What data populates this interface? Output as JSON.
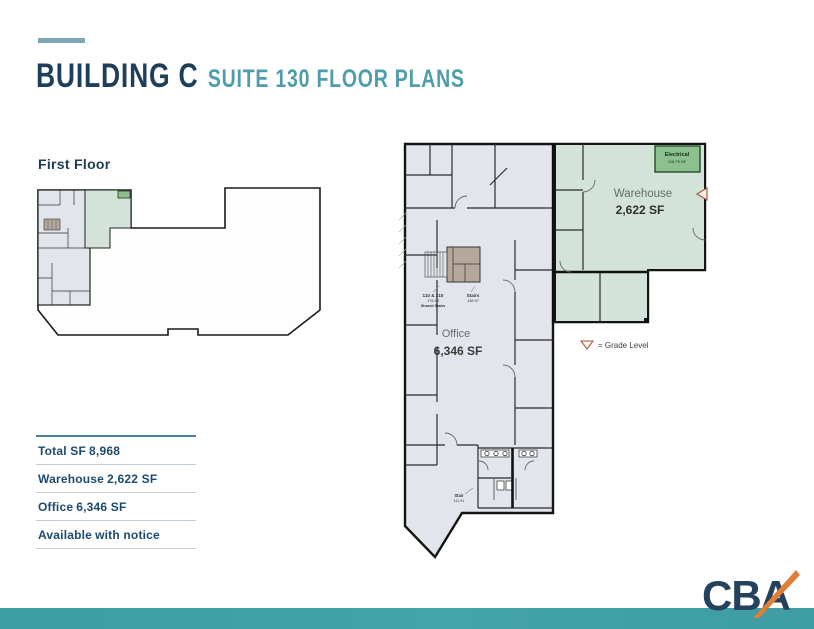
{
  "page": {
    "title": "BUILDING C",
    "subtitle": "SUITE 130 FLOOR PLANS"
  },
  "overview_plan": {
    "heading": "First Floor"
  },
  "main_plan": {
    "warehouse": {
      "label": "Warehouse",
      "area": "2,622 SF"
    },
    "office": {
      "label": "Office",
      "area": "6,346 SF"
    },
    "electrical": {
      "label": "Electrical",
      "area": "116.75 SF"
    },
    "stairs_shared": {
      "label": "110 & 210",
      "area": "176.13",
      "note": "Shared Stairs"
    },
    "stairs": {
      "label": "Stairs",
      "area": "138.97"
    },
    "stair_bottom": {
      "label": "Stair",
      "area": "111.91"
    },
    "legend": {
      "text": "= Grade Level"
    }
  },
  "stats": {
    "rows": [
      {
        "label": "Total SF",
        "value": "8,968"
      },
      {
        "label": "Warehouse",
        "value": "2,622 SF"
      },
      {
        "label": "Office",
        "value": "6,346 SF"
      },
      {
        "label": "Available",
        "value": "with notice"
      }
    ]
  },
  "footer": {
    "logo_text": "CBA"
  },
  "colors": {
    "navy": "#1e3e59",
    "teal": "#4f9dac",
    "teal_bar": "#3f9fa5",
    "office_fill": "#e2e6ec",
    "warehouse_fill": "#d4e3da",
    "electrical_fill": "#8cc08e",
    "stairs_fill": "#b5a89a",
    "grade_marker": "#a8543c"
  }
}
